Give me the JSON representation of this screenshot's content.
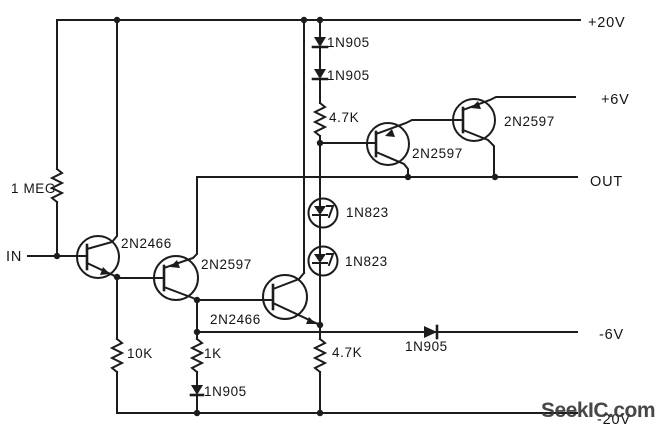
{
  "schematic": {
    "in_label": "IN",
    "rails": {
      "plus20": "+20V",
      "plus6": "+6V",
      "out": "OUT",
      "minus6": "-6V",
      "minus20": "-20V"
    },
    "resistors": {
      "r1": "1 MEG",
      "r2": "10K",
      "r3": "1K",
      "r4": "4.7K",
      "r5": "4.7K"
    },
    "diodes": {
      "d1": "1N905",
      "d2": "1N905",
      "d3": "1N905",
      "d4": "1N905"
    },
    "zeners": {
      "z1": "1N823",
      "z2": "1N823"
    },
    "transistors": {
      "q1": "2N2466",
      "q2": "2N2597",
      "q3": "2N2466",
      "q4": "2N2597",
      "q5": "2N2597"
    },
    "watermark": "SeekIC.com",
    "colors": {
      "line": "#1c1c1c",
      "background": "#ffffff",
      "watermark": "#3a3a3a"
    }
  }
}
